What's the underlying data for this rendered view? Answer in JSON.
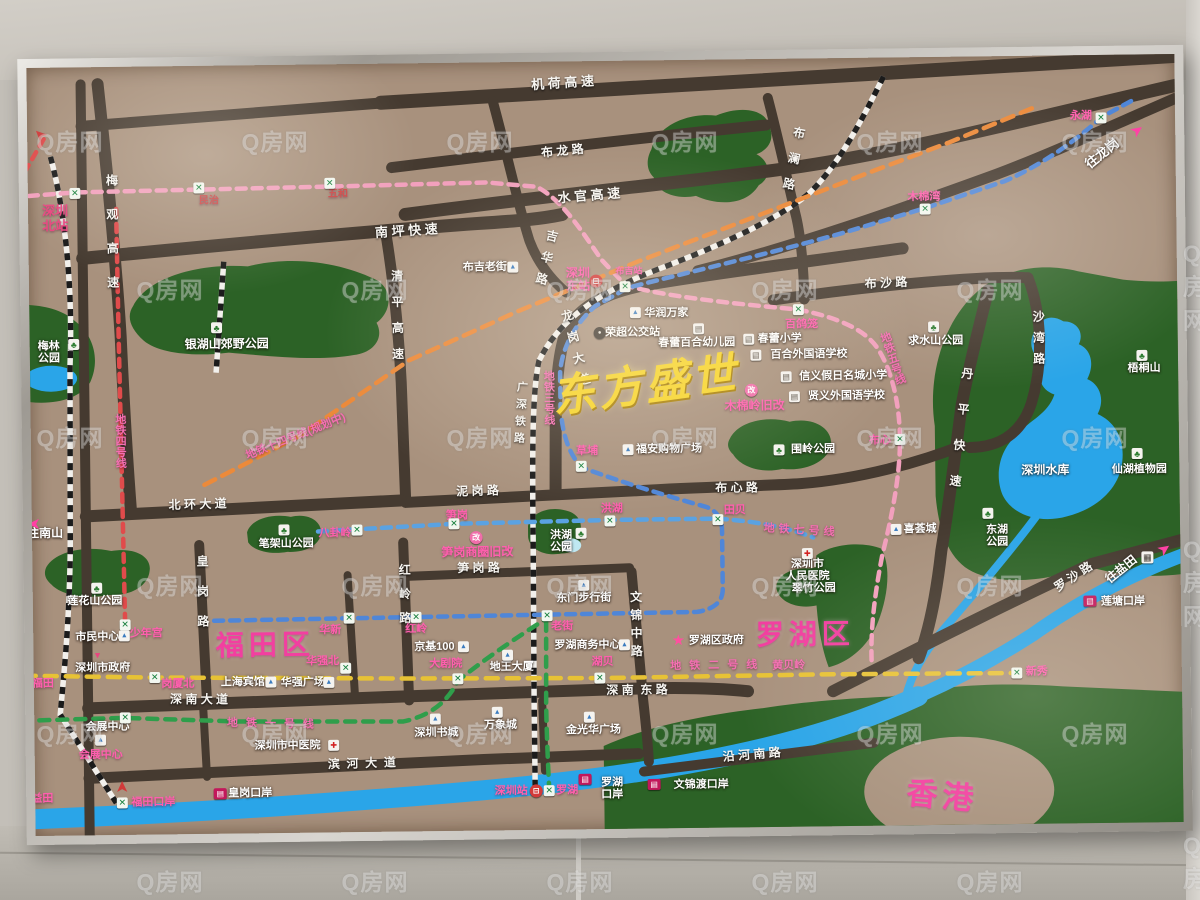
{
  "watermark": {
    "text": "Q房网"
  },
  "title": {
    "text": "东方盛世",
    "color": "#f6d428"
  },
  "colors": {
    "board": "#a8917d",
    "road": "#453a30",
    "park": "#2c6226",
    "water": "#2aa5e8",
    "pink_accent": "#ff5fae",
    "district_pink": "#f23fa0",
    "title_yellow": "#f6d428"
  },
  "metro_lines": [
    {
      "name": "地铁一号线",
      "color": "#2f9e4b"
    },
    {
      "name": "地铁二号线",
      "color": "#e7c235"
    },
    {
      "name": "地铁三号线",
      "color": "#4f86d8"
    },
    {
      "name": "地铁四号线",
      "color": "#e04b4b"
    },
    {
      "name": "地铁五号线",
      "color": "#f2a0bd"
    },
    {
      "name": "地铁七号线",
      "color": "#5aa2e2"
    },
    {
      "name": "地铁十四号线（规划中）",
      "color": "#ec8a3a"
    },
    {
      "name": "广深铁路",
      "color": "#1b1b1b"
    }
  ],
  "districts": [
    {
      "t": "福田区",
      "x": 263,
      "y": 641,
      "s": 28,
      "r": 0
    },
    {
      "t": "罗湖区",
      "x": 803,
      "y": 637,
      "s": 28,
      "r": 0
    },
    {
      "t": "香港",
      "x": 938,
      "y": 801,
      "s": 31,
      "r": 6
    }
  ],
  "title_pos": {
    "x": 646,
    "y": 386,
    "s": 44,
    "r": -7
  },
  "road_labels": [
    {
      "t": "机 荷 高 速",
      "x": 567,
      "y": 83,
      "r": -3,
      "s": 13
    },
    {
      "t": "布 龙 路",
      "x": 566,
      "y": 151,
      "r": -5,
      "s": 12
    },
    {
      "t": "水 官 高 速",
      "x": 592,
      "y": 196,
      "r": -4,
      "s": 13
    },
    {
      "t": "南 坪 快 速",
      "x": 409,
      "y": 229,
      "r": -3,
      "s": 13
    },
    {
      "t": "布 沙 路",
      "x": 888,
      "y": 287,
      "r": -2,
      "s": 12
    },
    {
      "t": "泥 岗 路",
      "x": 477,
      "y": 490,
      "r": -1,
      "s": 12
    },
    {
      "t": "布 心 路",
      "x": 736,
      "y": 490,
      "r": 0,
      "s": 12
    },
    {
      "t": "北 环 大 道",
      "x": 197,
      "y": 500,
      "r": -1,
      "s": 12
    },
    {
      "t": "笋 岗 路",
      "x": 477,
      "y": 567,
      "r": 0,
      "s": 12
    },
    {
      "t": "深 南 大 道",
      "x": 196,
      "y": 695,
      "r": 1,
      "s": 12
    },
    {
      "t": "深 南  东 路",
      "x": 634,
      "y": 691,
      "r": 0,
      "s": 12
    },
    {
      "t": "滨  河  大  道",
      "x": 358,
      "y": 761,
      "r": -1,
      "s": 12
    },
    {
      "t": "沿 河 南 路",
      "x": 748,
      "y": 757,
      "r": -4,
      "s": 12
    },
    {
      "t": "罗 沙 路",
      "x": 1072,
      "y": 583,
      "r": -33,
      "s": 12
    },
    {
      "t": "梅观高速",
      "x": 114,
      "y": 236,
      "v": 1,
      "ls": 22,
      "s": 12
    },
    {
      "t": "清平高速",
      "x": 398,
      "y": 319,
      "v": 1,
      "ls": 14,
      "s": 12
    },
    {
      "t": "吉华路",
      "x": 547,
      "y": 261,
      "v": 1,
      "ls": 10,
      "r": 14,
      "s": 12
    },
    {
      "t": "布澜路",
      "x": 795,
      "y": 167,
      "v": 1,
      "ls": 14,
      "r": 12,
      "s": 12
    },
    {
      "t": "沙湾路",
      "x": 1039,
      "y": 347,
      "v": 1,
      "ls": 9,
      "s": 12
    },
    {
      "t": "丹平快速",
      "x": 959,
      "y": 443,
      "v": 1,
      "ls": 24,
      "r": 7,
      "s": 12
    },
    {
      "t": "龙岗大道",
      "x": 577,
      "y": 352,
      "v": 1,
      "ls": 10,
      "r": -14,
      "s": 12
    },
    {
      "t": "皇岗路",
      "x": 200,
      "y": 595,
      "v": 1,
      "ls": 18,
      "s": 12
    },
    {
      "t": "红岭路",
      "x": 402,
      "y": 597,
      "v": 1,
      "ls": 12,
      "s": 12
    },
    {
      "t": "文锦中路",
      "x": 633,
      "y": 627,
      "v": 1,
      "ls": 6,
      "s": 12
    },
    {
      "t": "广深铁路",
      "x": 520,
      "y": 414,
      "v": 1,
      "ls": 6,
      "r": 4,
      "s": 11
    }
  ],
  "metro_text_labels": [
    {
      "t": "地铁四号线",
      "x": 120,
      "y": 435,
      "v": 1,
      "s": 11
    },
    {
      "t": "地铁十四号线(规划中)",
      "x": 296,
      "y": 433,
      "r": -21,
      "s": 11
    },
    {
      "t": "地铁三号线",
      "x": 549,
      "y": 397,
      "v": 1,
      "s": 11
    },
    {
      "t": "地铁五号线",
      "x": 893,
      "y": 362,
      "v": 1,
      "r": -18,
      "s": 11
    },
    {
      "t": "地铁七号线",
      "x": 800,
      "y": 533,
      "r": 4,
      "ls": 4,
      "s": 11
    },
    {
      "t": "地铁二号线",
      "x": 715,
      "y": 667,
      "ls": 8,
      "s": 11
    },
    {
      "t": "黄贝岭",
      "x": 786,
      "y": 668,
      "s": 11
    },
    {
      "t": "地铁一号线",
      "x": 271,
      "y": 720,
      "ls": 8,
      "r": 2,
      "s": 11
    }
  ],
  "station_labels": [
    {
      "t": "深圳\n北站",
      "x": 58,
      "y": 212,
      "s": 13,
      "c": "#e8457f"
    },
    {
      "t": "民治",
      "x": 212,
      "y": 196,
      "s": 10,
      "c": "#cc4747"
    },
    {
      "t": "五和",
      "x": 341,
      "y": 191,
      "s": 10,
      "c": "#cc4747"
    },
    {
      "t": "永湖",
      "x": 1085,
      "y": 122,
      "s": 11
    },
    {
      "t": "木棉湾",
      "x": 927,
      "y": 201,
      "s": 11
    },
    {
      "t": "百鸽笼",
      "x": 803,
      "y": 327,
      "s": 11
    },
    {
      "t": "深圳\n东站",
      "x": 580,
      "y": 280,
      "s": 12
    },
    {
      "t": "布吉站",
      "x": 631,
      "y": 271,
      "s": 9
    },
    {
      "t": "草埔",
      "x": 587,
      "y": 451,
      "s": 11
    },
    {
      "t": "布心",
      "x": 880,
      "y": 444,
      "s": 11
    },
    {
      "t": "八卦岭",
      "x": 334,
      "y": 530,
      "s": 11
    },
    {
      "t": "笋岗",
      "x": 456,
      "y": 514,
      "s": 11
    },
    {
      "t": "洪湖",
      "x": 611,
      "y": 509,
      "s": 11
    },
    {
      "t": "田贝",
      "x": 734,
      "y": 512,
      "s": 11
    },
    {
      "t": "少年宫",
      "x": 144,
      "y": 628,
      "s": 11
    },
    {
      "t": "福田",
      "x": 40,
      "y": 677,
      "s": 11
    },
    {
      "t": "岗厦北",
      "x": 175,
      "y": 679,
      "s": 11
    },
    {
      "t": "华新",
      "x": 328,
      "y": 627,
      "s": 11
    },
    {
      "t": "红岭",
      "x": 414,
      "y": 627,
      "s": 11
    },
    {
      "t": "老街",
      "x": 560,
      "y": 626,
      "s": 11
    },
    {
      "t": "华强北",
      "x": 320,
      "y": 658,
      "s": 11
    },
    {
      "t": "大剧院",
      "x": 443,
      "y": 662,
      "s": 11
    },
    {
      "t": "湖贝",
      "x": 600,
      "y": 662,
      "s": 11
    },
    {
      "t": "会展中心",
      "x": 97,
      "y": 749,
      "s": 11
    },
    {
      "t": "新秀",
      "x": 1034,
      "y": 677,
      "s": 11
    },
    {
      "t": "福田口岸",
      "x": 149,
      "y": 797,
      "s": 11
    },
    {
      "t": "益田",
      "x": 38,
      "y": 792,
      "s": 11
    },
    {
      "t": "深圳站",
      "x": 507,
      "y": 790,
      "s": 11
    },
    {
      "t": "罗湖",
      "x": 563,
      "y": 790,
      "s": 11
    },
    {
      "t": "笋岗商圈旧改",
      "x": 476,
      "y": 551,
      "s": 12
    },
    {
      "t": "木棉岭旧改",
      "x": 755,
      "y": 408,
      "s": 12
    }
  ],
  "place_labels": [
    {
      "t": "梅林\n公园",
      "x": 50,
      "y": 346,
      "s": 11
    },
    {
      "t": "银湖山郊野公园",
      "x": 228,
      "y": 340,
      "s": 12
    },
    {
      "t": "布吉老街",
      "x": 487,
      "y": 266,
      "s": 11
    },
    {
      "t": "荣超公交站",
      "x": 634,
      "y": 333,
      "s": 11
    },
    {
      "t": "华润万家",
      "x": 668,
      "y": 314,
      "s": 11
    },
    {
      "t": "春蕾百合幼儿园",
      "x": 698,
      "y": 344,
      "s": 11
    },
    {
      "t": "春蕾小学",
      "x": 781,
      "y": 341,
      "s": 11
    },
    {
      "t": "百合外国语学校",
      "x": 810,
      "y": 357,
      "s": 11
    },
    {
      "t": "信义假日名城小学",
      "x": 844,
      "y": 379,
      "s": 11
    },
    {
      "t": "贤义外国语学校",
      "x": 847,
      "y": 399,
      "s": 11
    },
    {
      "t": "福安购物广场",
      "x": 669,
      "y": 450,
      "s": 11
    },
    {
      "t": "围岭公园",
      "x": 813,
      "y": 452,
      "s": 11
    },
    {
      "t": "求水山公园",
      "x": 937,
      "y": 345,
      "s": 11
    },
    {
      "t": "梧桐山",
      "x": 1145,
      "y": 375,
      "s": 11
    },
    {
      "t": "深圳水库",
      "x": 1045,
      "y": 476,
      "s": 12
    },
    {
      "t": "仙湖植物园",
      "x": 1139,
      "y": 476,
      "s": 11
    },
    {
      "t": "东湖\n公园",
      "x": 996,
      "y": 541,
      "s": 11
    },
    {
      "t": "喜荟城",
      "x": 919,
      "y": 533,
      "s": 11
    },
    {
      "t": "莲花山公园",
      "x": 93,
      "y": 595,
      "s": 11
    },
    {
      "t": "笔架山公园",
      "x": 285,
      "y": 540,
      "s": 11
    },
    {
      "t": "市民中心",
      "x": 95,
      "y": 631,
      "s": 11
    },
    {
      "t": "深圳市政府",
      "x": 100,
      "y": 662,
      "s": 11
    },
    {
      "t": "上海宾馆",
      "x": 240,
      "y": 678,
      "s": 11
    },
    {
      "t": "华强广场",
      "x": 300,
      "y": 679,
      "s": 11
    },
    {
      "t": "东门步行街",
      "x": 582,
      "y": 598,
      "s": 11
    },
    {
      "t": "京基100",
      "x": 432,
      "y": 645,
      "s": 11
    },
    {
      "t": "地王大厦",
      "x": 509,
      "y": 666,
      "s": 11
    },
    {
      "t": "罗湖商务中心",
      "x": 585,
      "y": 645,
      "s": 11
    },
    {
      "t": "罗湖区政府",
      "x": 714,
      "y": 642,
      "s": 11
    },
    {
      "t": "深圳市\n人民医院",
      "x": 806,
      "y": 573,
      "s": 11
    },
    {
      "t": "翠竹公园",
      "x": 812,
      "y": 591,
      "s": 11
    },
    {
      "t": "洪湖\n公园",
      "x": 560,
      "y": 541,
      "s": 11
    },
    {
      "t": "深圳市中医院",
      "x": 284,
      "y": 742,
      "s": 11
    },
    {
      "t": "会展中心",
      "x": 104,
      "y": 721,
      "s": 11
    },
    {
      "t": "深圳书城",
      "x": 433,
      "y": 731,
      "s": 11
    },
    {
      "t": "万象城",
      "x": 497,
      "y": 724,
      "s": 11
    },
    {
      "t": "金光华广场",
      "x": 590,
      "y": 730,
      "s": 11
    },
    {
      "t": "皇岗口岸",
      "x": 246,
      "y": 789,
      "s": 11
    },
    {
      "t": "罗湖\n口岸",
      "x": 608,
      "y": 789,
      "s": 11
    },
    {
      "t": "文锦渡口岸",
      "x": 697,
      "y": 786,
      "s": 11
    },
    {
      "t": "莲塘口岸",
      "x": 1121,
      "y": 608,
      "s": 11
    }
  ],
  "direction_labels": [
    {
      "t": "往南山",
      "x": 44,
      "y": 527,
      "s": 12
    },
    {
      "t": "往龙岗",
      "x": 1106,
      "y": 160,
      "r": -38,
      "s": 13
    },
    {
      "t": "往盐田",
      "x": 1120,
      "y": 576,
      "r": -38,
      "s": 12
    }
  ],
  "metro_station_icons": [
    {
      "x": 78,
      "y": 187
    },
    {
      "x": 202,
      "y": 183
    },
    {
      "x": 333,
      "y": 180
    },
    {
      "x": 800,
      "y": 312
    },
    {
      "x": 928,
      "y": 213
    },
    {
      "x": 1105,
      "y": 124
    },
    {
      "x": 627,
      "y": 287
    },
    {
      "x": 581,
      "y": 466
    },
    {
      "x": 900,
      "y": 443
    },
    {
      "x": 356,
      "y": 527
    },
    {
      "x": 453,
      "y": 522
    },
    {
      "x": 609,
      "y": 521
    },
    {
      "x": 717,
      "y": 521
    },
    {
      "x": 123,
      "y": 619
    },
    {
      "x": 25,
      "y": 668
    },
    {
      "x": 152,
      "y": 672
    },
    {
      "x": 347,
      "y": 615
    },
    {
      "x": 414,
      "y": 615
    },
    {
      "x": 545,
      "y": 615
    },
    {
      "x": 343,
      "y": 665
    },
    {
      "x": 455,
      "y": 677
    },
    {
      "x": 597,
      "y": 678
    },
    {
      "x": 122,
      "y": 712
    },
    {
      "x": 1014,
      "y": 678
    },
    {
      "x": 118,
      "y": 797
    },
    {
      "x": 22,
      "y": 790
    },
    {
      "x": 545,
      "y": 790
    }
  ],
  "misc_icons": [
    {
      "type": "train-icon",
      "x": 598,
      "y": 281
    },
    {
      "type": "train-icon",
      "x": 532,
      "y": 790
    },
    {
      "type": "bus-icon",
      "x": 601,
      "y": 333
    },
    {
      "type": "port-icon",
      "x": 216,
      "y": 789
    },
    {
      "type": "port-icon",
      "x": 581,
      "y": 779
    },
    {
      "type": "port-icon",
      "x": 650,
      "y": 785
    },
    {
      "type": "port-icon",
      "x": 1088,
      "y": 607
    },
    {
      "type": "star-icon",
      "x": 676,
      "y": 641
    },
    {
      "type": "marker-icon",
      "x": 95,
      "y": 649
    },
    {
      "type": "project-icon",
      "x": 475,
      "y": 536
    },
    {
      "type": "project-icon",
      "x": 752,
      "y": 392
    },
    {
      "type": "grid-icon",
      "x": 1146,
      "y": 564
    },
    {
      "type": "school-icon",
      "x": 700,
      "y": 330
    },
    {
      "type": "school-icon",
      "x": 750,
      "y": 341
    },
    {
      "type": "school-icon",
      "x": 757,
      "y": 357
    },
    {
      "type": "school-icon",
      "x": 787,
      "y": 379
    },
    {
      "type": "school-icon",
      "x": 795,
      "y": 399
    },
    {
      "type": "park-icon",
      "x": 75,
      "y": 338
    },
    {
      "type": "park-icon",
      "x": 218,
      "y": 323
    },
    {
      "type": "park-icon",
      "x": 95,
      "y": 582
    },
    {
      "type": "park-icon",
      "x": 283,
      "y": 526
    },
    {
      "type": "park-icon",
      "x": 935,
      "y": 331
    },
    {
      "type": "park-icon",
      "x": 1143,
      "y": 362
    },
    {
      "type": "park-icon",
      "x": 987,
      "y": 518
    },
    {
      "type": "park-icon",
      "x": 1137,
      "y": 460
    },
    {
      "type": "park-icon",
      "x": 779,
      "y": 452
    },
    {
      "type": "park-icon",
      "x": 580,
      "y": 533
    },
    {
      "type": "building-icon",
      "x": 515,
      "y": 266
    },
    {
      "type": "building-icon",
      "x": 637,
      "y": 313
    },
    {
      "type": "building-icon",
      "x": 628,
      "y": 450
    },
    {
      "type": "building-icon",
      "x": 122,
      "y": 630
    },
    {
      "type": "building-icon",
      "x": 268,
      "y": 678
    },
    {
      "type": "building-icon",
      "x": 326,
      "y": 679
    },
    {
      "type": "building-icon",
      "x": 461,
      "y": 645
    },
    {
      "type": "building-icon",
      "x": 505,
      "y": 654
    },
    {
      "type": "building-icon",
      "x": 622,
      "y": 645
    },
    {
      "type": "building-icon",
      "x": 582,
      "y": 585
    },
    {
      "type": "building-icon",
      "x": 97,
      "y": 734
    },
    {
      "type": "building-icon",
      "x": 432,
      "y": 717
    },
    {
      "type": "building-icon",
      "x": 494,
      "y": 711
    },
    {
      "type": "building-icon",
      "x": 586,
      "y": 717
    },
    {
      "type": "building-icon",
      "x": 895,
      "y": 533
    },
    {
      "type": "hospital-icon",
      "x": 330,
      "y": 742
    },
    {
      "type": "hospital-icon",
      "x": 806,
      "y": 556
    },
    {
      "type": "arrow-icon",
      "x": 1141,
      "y": 137,
      "r": -35,
      "c": "#ff3fa4"
    },
    {
      "type": "arrow-icon",
      "x": 1163,
      "y": 556,
      "r": -35,
      "c": "#ff3fa4"
    },
    {
      "type": "arrow-icon",
      "x": 33,
      "y": 517,
      "r": 180,
      "c": "#ff3fa4"
    },
    {
      "type": "arrow-icon",
      "x": 118,
      "y": 781,
      "r": -90,
      "c": "#d03a3a"
    },
    {
      "type": "arrow-icon",
      "x": 44,
      "y": 128,
      "r": -135,
      "c": "#d03a3a"
    }
  ]
}
